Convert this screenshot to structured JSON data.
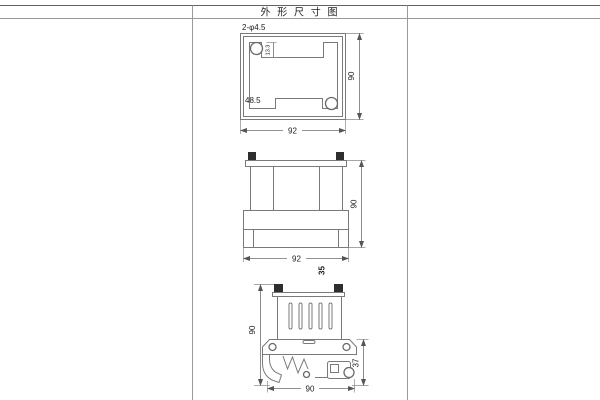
{
  "title": "外 形 尺 寸 图",
  "top_view": {
    "hole_callout": "2-φ4.5",
    "notch_depth": "13.3",
    "inner_dim": "48.5",
    "height": "90",
    "width": "92"
  },
  "front_view": {
    "height": "90",
    "width": "92",
    "depth": "35"
  },
  "side_view": {
    "height": "90",
    "bracket_height": "37",
    "width": "90"
  }
}
